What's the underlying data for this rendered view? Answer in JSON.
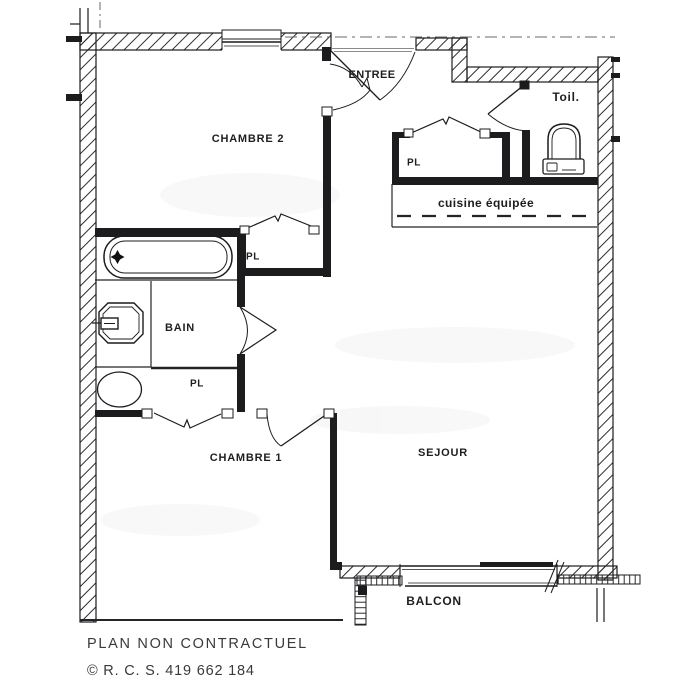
{
  "labels": {
    "entree": "ENTREE",
    "toilet": "Toil.",
    "chambre2": "CHAMBRE 2",
    "closet_entry": "PL",
    "cuisine": "cuisine équipée",
    "closet_chambre2": "PL",
    "bain": "BAIN",
    "closet_bain": "PL",
    "chambre1": "CHAMBRE 1",
    "sejour": "SEJOUR",
    "balcon": "BALCON"
  },
  "footer": {
    "disclaimer": "PLAN NON CONTRACTUEL",
    "registration": "© R. C. S. 419 662 184"
  },
  "fixtures": {
    "bathtub": "bathtub-icon",
    "washbasin": "washbasin-icon",
    "washing_machine": "washing-machine-icon",
    "toilet": "toilet-icon"
  },
  "colors": {
    "ink": "#1c1c1e",
    "paper": "#ffffff",
    "faint": "#8a8a8a"
  }
}
